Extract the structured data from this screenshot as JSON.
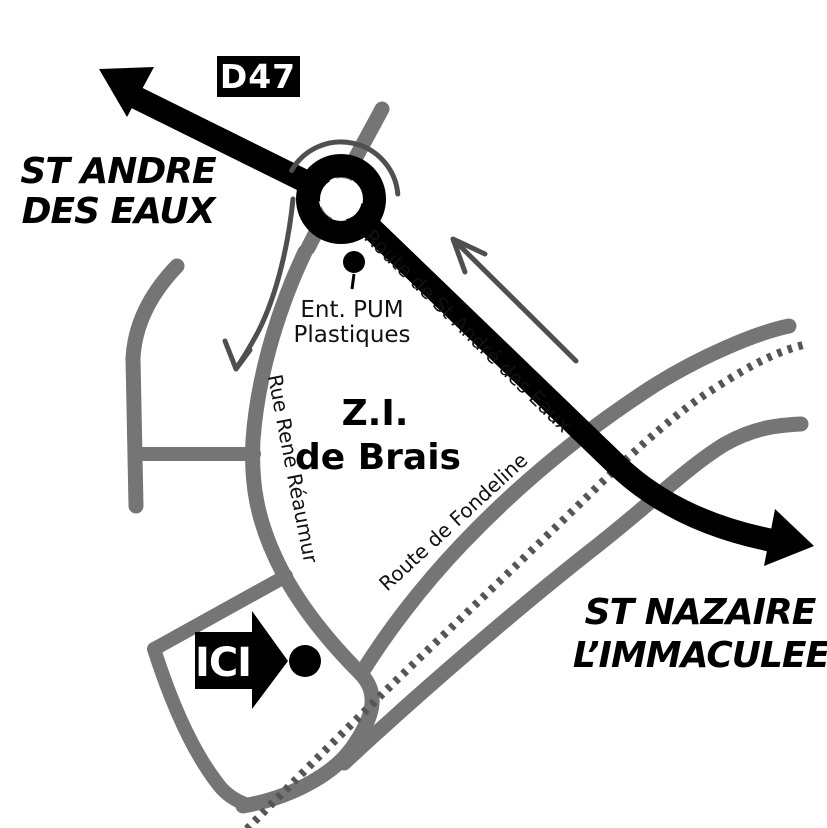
{
  "map": {
    "background": "#ffffff",
    "colors": {
      "main_route": "#000000",
      "secondary_roads": "#757575",
      "railway": "#555555",
      "direction_arrows": "#4f4f4f",
      "badge_background": "#000000",
      "badge_text": "#ffffff",
      "label_text": "#000000"
    },
    "labels": {
      "d47_badge": "D47",
      "st_andre_line1": "ST ANDRE",
      "st_andre_line2": "DES EAUX",
      "ent_pum_line1": "Ent. PUM",
      "ent_pum_line2": "Plastiques",
      "route_st_andre": "Route de St André des Eaux",
      "zi_line1": "Z.I.",
      "zi_line2": "de Brais",
      "rue_rene_reaumur": "Rue René Réaumur",
      "route_fondeline": "Route de Fondeline",
      "st_nazaire_line1": "ST NAZAIRE",
      "st_nazaire_line2": "L’IMMACULEE",
      "ici_marker": "ICI"
    }
  }
}
